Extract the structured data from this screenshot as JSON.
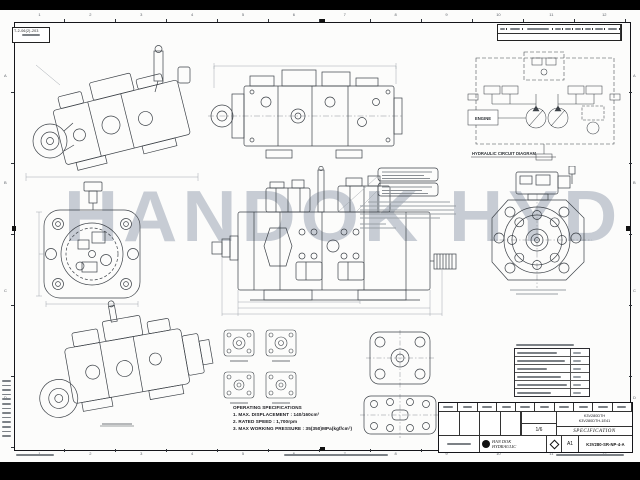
{
  "sheet": {
    "watermark": "HANDOK HYD",
    "watermark_color": "#c7ccd4",
    "stamp_code": "T-2-06(2)-203",
    "grid_numbers": [
      "1",
      "2",
      "3",
      "4",
      "5",
      "6",
      "7",
      "8",
      "9",
      "10",
      "11",
      "12"
    ],
    "grid_letters": [
      "A",
      "B",
      "C",
      "D"
    ]
  },
  "circuit": {
    "engine": "ENGINE",
    "caption": "HYDRAULIC CIRCUIT DIAGRAM"
  },
  "operating_specs": {
    "title": "OPERATING SPECIFICATIONS",
    "lines": [
      "1. MAX. DISPLACEMENT : 140/160cm³",
      "2. RATED SPEED : 1,700rpm",
      "3. MAX WORKING PRESSURE : 35(350)MPa(kgf/cm²)"
    ]
  },
  "title_block": {
    "company_line1": "HAN DOK",
    "company_line2": "HYDRAULIC",
    "specification": "SPECIFICATION",
    "part_code_line1": "K3V280DTH",
    "part_code_line2": "K3V280DTH-1E41",
    "scale": "1/6",
    "sheet_size": "A1",
    "drawing_no": "K3V280-SR-NP-4-A"
  }
}
